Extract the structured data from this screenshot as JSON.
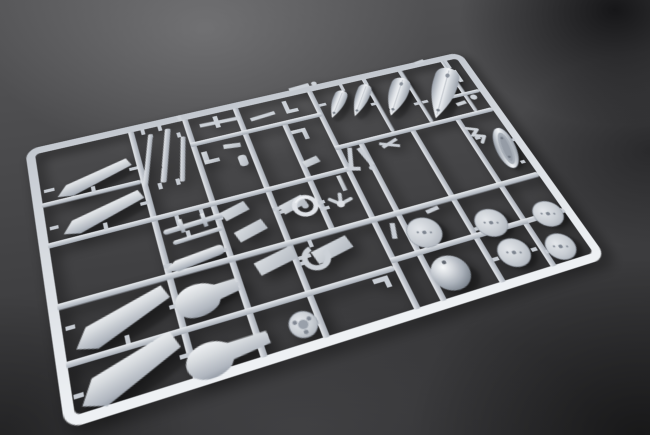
{
  "scene": {
    "type": "photograph",
    "subject": "Light gray injection-molded model kit sprue (parts tree) photographed at an angle on a dark charcoal studio background",
    "camera_angle": "high three-quarter view, frame receding toward upper right",
    "lighting": "soft light from upper left, vignetted corners, dark shadow blob in upper-right corner"
  },
  "palette": {
    "plastic_highlight": "#f1f3f5",
    "plastic_mid": "#c7ccd3",
    "plastic_shadow": "#9aa1ab",
    "background_light": "#565658",
    "background_dark": "#303032",
    "corner_shadow": "#0a0a0c"
  },
  "sprue": {
    "color_name": "light gray",
    "frame_shape": "rounded rectangle frame with internal runner lattice",
    "parts_inventory": [
      {
        "name": "wing / flap blade panels",
        "count": 4,
        "location": "left column"
      },
      {
        "name": "thin strip fairings",
        "count": 3,
        "location": "upper left"
      },
      {
        "name": "drop tank halves (graduated sizes)",
        "count": 4,
        "location": "top right"
      },
      {
        "name": "float / pod half",
        "count": 1,
        "location": "right edge"
      },
      {
        "name": "wheel discs",
        "count": 5,
        "location": "lower right"
      },
      {
        "name": "cowling dome",
        "count": 1,
        "location": "lower right"
      },
      {
        "name": "open cowl ring",
        "count": 1,
        "location": "lower middle"
      },
      {
        "name": "hub wheel with holes",
        "count": 1,
        "location": "lower middle"
      },
      {
        "name": "paddle-shaped gear doors",
        "count": 2,
        "location": "bottom center"
      },
      {
        "name": "torpedo / fairing body",
        "count": 1,
        "location": "middle left"
      },
      {
        "name": "small ring",
        "count": 1,
        "location": "sprue center"
      },
      {
        "name": "assorted rods, plates, struts, brackets",
        "count": 24,
        "location": "central cells"
      }
    ]
  }
}
